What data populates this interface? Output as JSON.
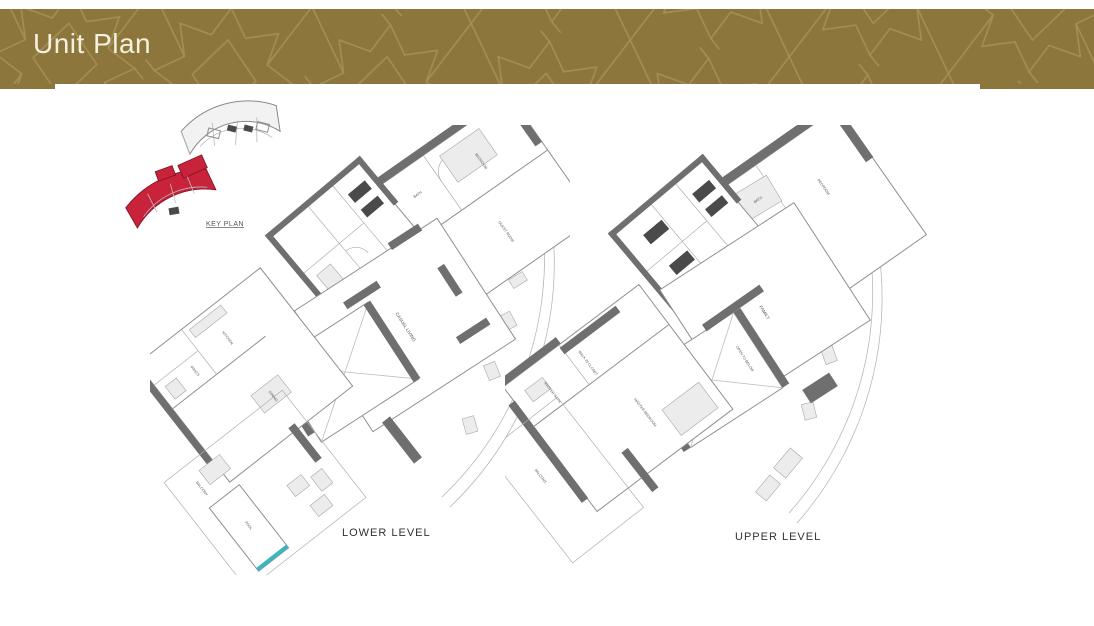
{
  "header": {
    "title": "Unit Plan"
  },
  "colors": {
    "band": "#8C763B",
    "pattern": "#A7925A",
    "title_text": "#F6F1DF",
    "highlight_red": "#C8233B",
    "wall_gray": "#6F6F6F",
    "pool_teal": "#3EB5C0"
  },
  "key_plan": {
    "label": "KEY PLAN"
  },
  "plans": {
    "lower": {
      "caption": "LOWER LEVEL",
      "rooms": [
        {
          "label": "BATH"
        },
        {
          "label": "BEDROOM"
        },
        {
          "label": "GUEST ROOM"
        },
        {
          "label": "CASUAL LIVING"
        },
        {
          "label": "FORMAL LIVING"
        },
        {
          "label": "KITCHEN"
        },
        {
          "label": "MAID'S"
        },
        {
          "label": "DINING"
        },
        {
          "label": "BALCONY"
        },
        {
          "label": "POOL"
        }
      ]
    },
    "upper": {
      "caption": "UPPER LEVEL",
      "rooms": [
        {
          "label": "BATH"
        },
        {
          "label": "W.I.C"
        },
        {
          "label": "BEDROOM"
        },
        {
          "label": "FAMILY"
        },
        {
          "label": "OPEN TO BELOW"
        },
        {
          "label": "MASTER BATH"
        },
        {
          "label": "WALK IN CLOSET"
        },
        {
          "label": "MASTER BEDROOM"
        },
        {
          "label": "BALCONY"
        },
        {
          "label": "BALCONY"
        }
      ]
    }
  }
}
